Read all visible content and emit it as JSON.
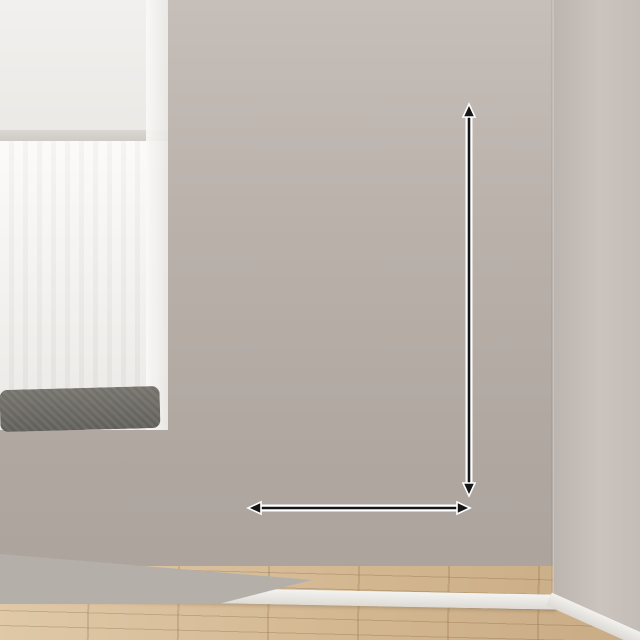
{
  "ribbons": {
    "dark_text": "加厚边框",
    "light_text": "送精美挂钩",
    "slogan_text": "良心实材/可开发票"
  },
  "pegboard": {
    "title": "CARPE DIEM",
    "items": [
      "switch-console",
      "headphones",
      "navy-cap",
      "beige-cap",
      "round-badge",
      "face-mask",
      "tissue-box",
      "polaroid-photo",
      "polaroid-photo-tilted",
      "handbag",
      "water-bottle",
      "umbrella"
    ]
  },
  "dimensions": {
    "height_label": "100cm",
    "width_label": "50cm"
  },
  "colors": {
    "ribbon_dark": "#33495b",
    "ribbon_light": "#f8f8f5",
    "board": "#323136",
    "board_frame": "#3a393f",
    "wall": "#b6ada7",
    "floor_wood": "#d3b791",
    "annotation_text": "#141414",
    "annotation_outline": "#ffffff",
    "mask_tag_green": "#2fa36c"
  }
}
